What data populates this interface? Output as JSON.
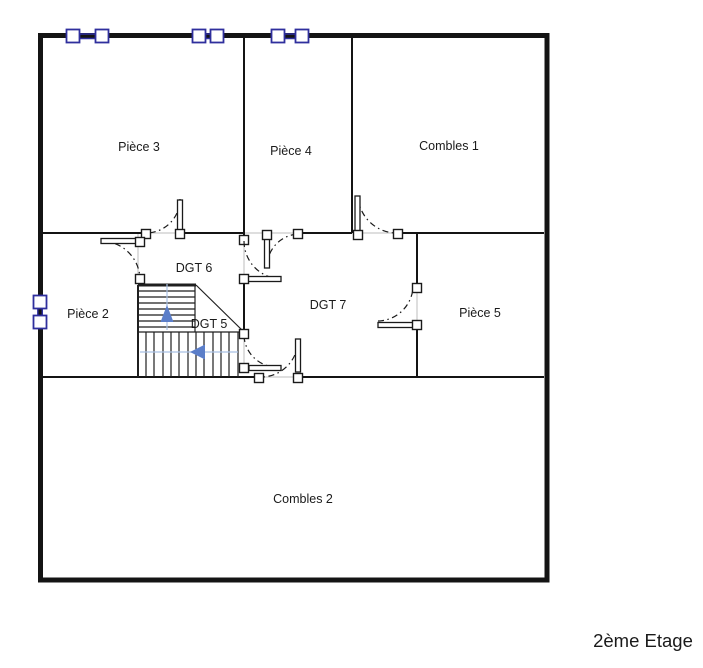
{
  "title": {
    "label": "2ème Etage"
  },
  "rooms": {
    "piece3": {
      "label": "Pièce 3"
    },
    "piece4": {
      "label": "Pièce 4"
    },
    "combles1": {
      "label": "Combles 1"
    },
    "dgt6": {
      "label": "DGT 6"
    },
    "piece2": {
      "label": "Pièce 2"
    },
    "dgt5": {
      "label": "DGT 5"
    },
    "dgt7": {
      "label": "DGT 7"
    },
    "piece5": {
      "label": "Pièce 5"
    },
    "combles2": {
      "label": "Combles 2"
    }
  },
  "colors": {
    "wall": "#141414",
    "door": "#1a1a1a",
    "window_accent": "#2f2f9d",
    "stair_arrow": "#5b7ec9",
    "stair_guide": "#a9c0e4",
    "zone_guide": "#c9c9c9"
  }
}
